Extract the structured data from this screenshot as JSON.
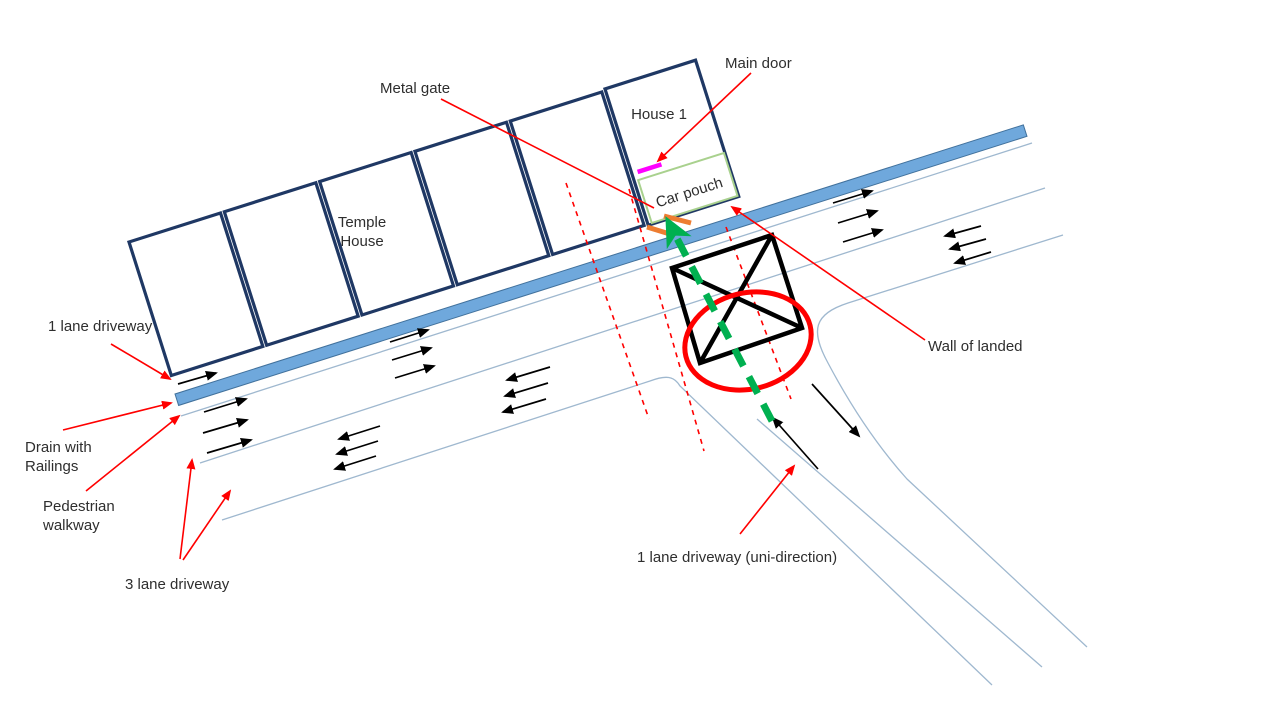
{
  "diagram": {
    "labels": {
      "metal_gate": "Metal gate",
      "main_door": "Main door",
      "house_1": "House 1",
      "temple_house_line1": "Temple",
      "temple_house_line2": "House",
      "car_pouch": "Car pouch",
      "wall_of_landed": "Wall of landed",
      "one_lane_driveway": "1 lane driveway",
      "drain_line1": "Drain with",
      "drain_line2": "Railings",
      "pedestrian_line1": "Pedestrian",
      "pedestrian_line2": "walkway",
      "three_lane_driveway": "3 lane driveway",
      "one_lane_uni": "1 lane driveway (uni-direction)"
    },
    "colors": {
      "house_border": "#1F3864",
      "drain_fill": "#6FA8DC",
      "drain_border": "#41719C",
      "road_line": "#9FB8CF",
      "annotation_red": "#FF0000",
      "traffic_arrow_black": "#000000",
      "gate_orange": "#ED7D31",
      "main_door_magenta": "#FF00FF",
      "car_path_green": "#00B050",
      "car_pouch_border": "#A9D18E",
      "label_text": "#2E2E2E"
    },
    "icons": {
      "red_arrowhead_icon": "filled-triangle",
      "black_arrowhead_icon": "filled-triangle",
      "green_arrowhead_icon": "filled-chevron"
    }
  }
}
